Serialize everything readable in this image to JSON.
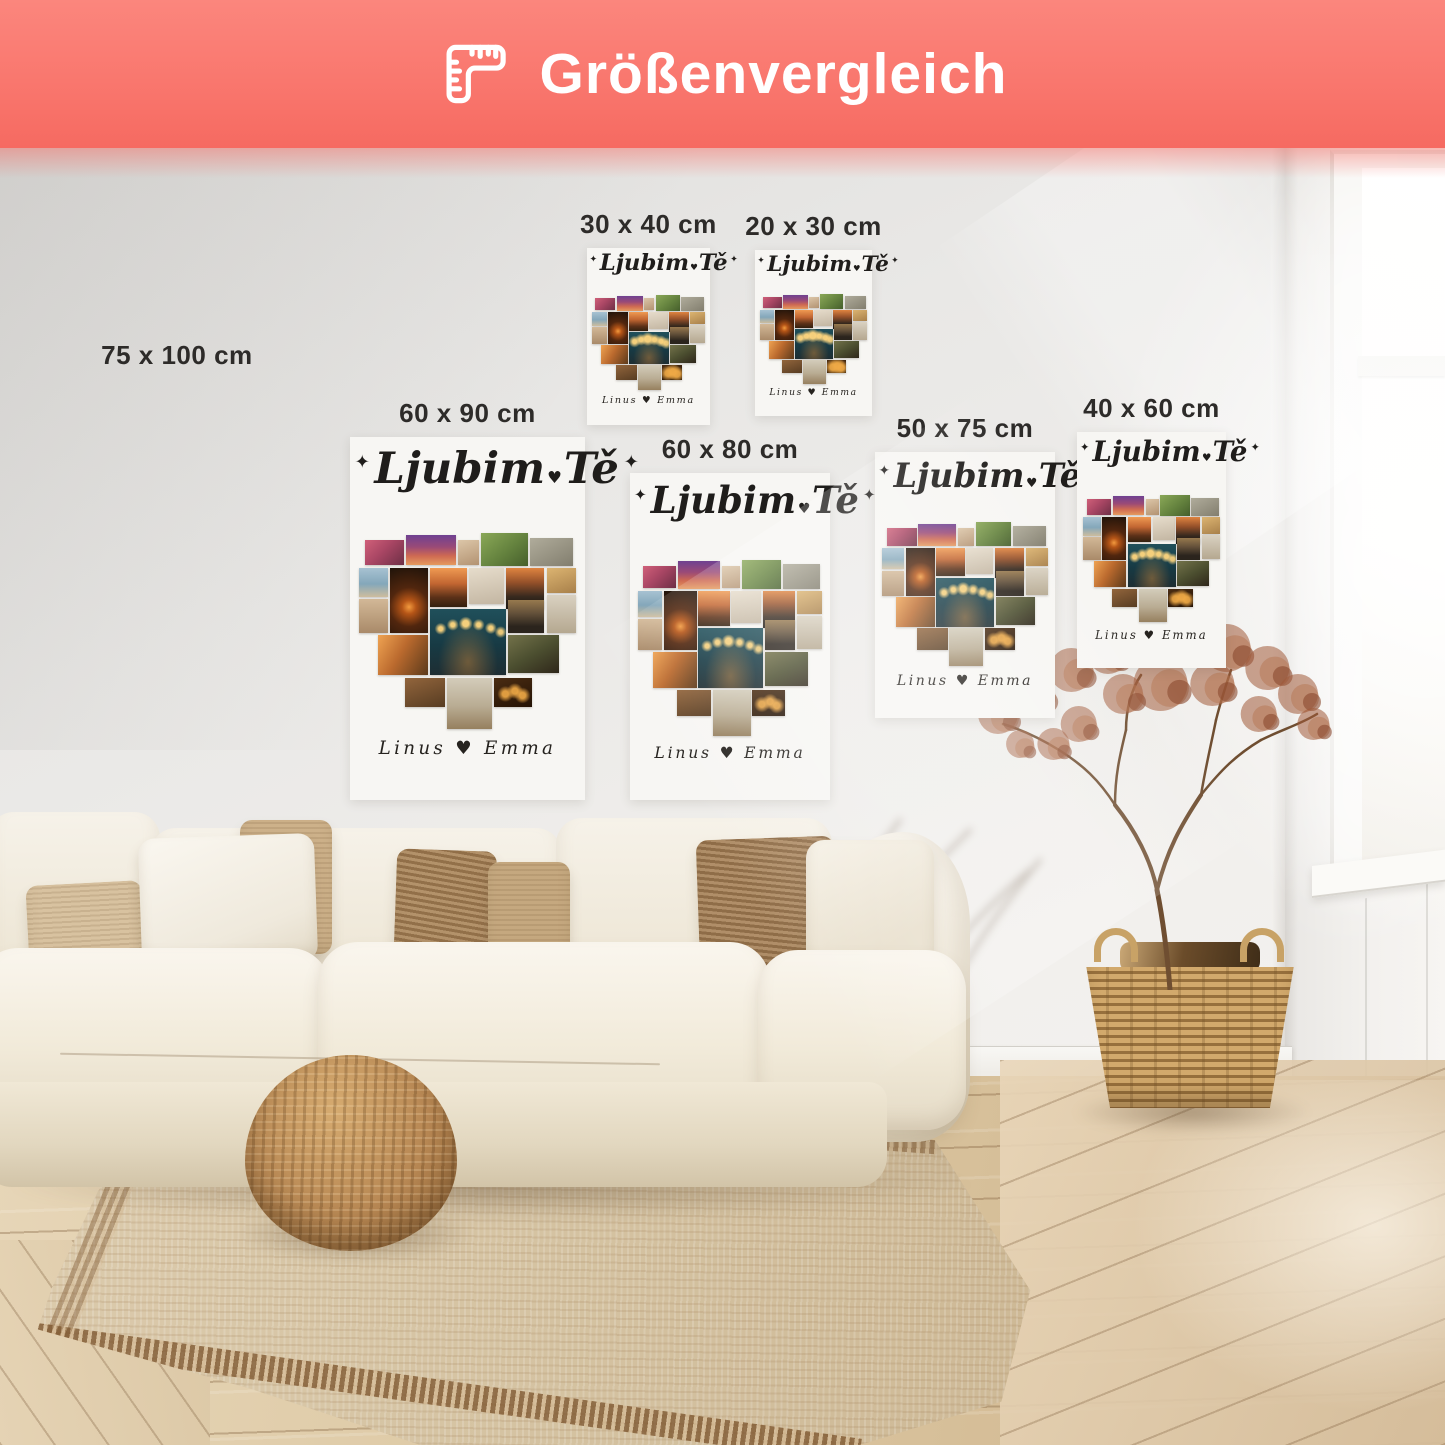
{
  "banner": {
    "title": "Größenvergleich",
    "icon": "ruler-icon",
    "bg_color": "#F9776E",
    "text_color": "#FFFFFF"
  },
  "poster_design": {
    "title_word1": "Ljubim",
    "title_word2": "Tě",
    "title_separator": "♥",
    "sparkle": "✦",
    "names": "Linus ♥ Emma",
    "ink_color": "#1F1D1B"
  },
  "sizes": [
    {
      "id": "75x100",
      "label": "75 x 100 cm",
      "print": false,
      "x": 7.0,
      "y": 23.5,
      "w": 9.5,
      "h": 2.5
    },
    {
      "id": "30x40",
      "label": "30 x 40 cm",
      "print": true,
      "x": 40.62,
      "y": 17.16,
      "w": 8.51,
      "h": 12.25
    },
    {
      "id": "20x30",
      "label": "20 x 30 cm",
      "print": true,
      "x": 52.25,
      "y": 17.3,
      "w": 8.1,
      "h": 11.49
    },
    {
      "id": "60x90",
      "label": "60 x 90 cm",
      "print": true,
      "x": 24.22,
      "y": 30.24,
      "w": 16.26,
      "h": 25.12
    },
    {
      "id": "60x80",
      "label": "60 x 80 cm",
      "print": true,
      "x": 43.6,
      "y": 32.73,
      "w": 13.84,
      "h": 22.63
    },
    {
      "id": "50x75",
      "label": "50 x 75 cm",
      "print": true,
      "x": 60.55,
      "y": 31.28,
      "w": 12.46,
      "h": 18.41
    },
    {
      "id": "40x60",
      "label": "40 x 60 cm",
      "print": true,
      "x": 74.53,
      "y": 29.9,
      "w": 10.31,
      "h": 16.33
    }
  ],
  "collage_tiles": [
    {
      "n": "photo-party",
      "c": "t1",
      "x": 2.8,
      "y": 3.6,
      "w": 18.0,
      "h": 12.6
    },
    {
      "n": "photo-palms-sunset",
      "c": "t2",
      "x": 21.8,
      "y": 0.8,
      "w": 23.0,
      "h": 15.6
    },
    {
      "n": "photo-beach-small",
      "c": "t3",
      "x": 45.8,
      "y": 3.6,
      "w": 9.4,
      "h": 12.6
    },
    {
      "n": "photo-picnic",
      "c": "t4",
      "x": 56.4,
      "y": 0.0,
      "w": 21.4,
      "h": 16.6
    },
    {
      "n": "photo-friends",
      "c": "t5",
      "x": 79.0,
      "y": 2.6,
      "w": 20.0,
      "h": 14.0
    },
    {
      "n": "photo-beach-walk",
      "c": "t6",
      "x": 0.0,
      "y": 17.6,
      "w": 13.2,
      "h": 15.0
    },
    {
      "n": "photo-campfire",
      "c": "t7",
      "x": 14.2,
      "y": 17.6,
      "w": 17.6,
      "h": 33.4
    },
    {
      "n": "photo-palm-beach",
      "c": "t8",
      "x": 32.8,
      "y": 17.6,
      "w": 17.0,
      "h": 20.0
    },
    {
      "n": "photo-group-light",
      "c": "t9",
      "x": 50.8,
      "y": 17.6,
      "w": 16.2,
      "h": 18.4
    },
    {
      "n": "photo-sea-sunset",
      "c": "t10",
      "x": 68.0,
      "y": 17.6,
      "w": 17.6,
      "h": 21.0
    },
    {
      "n": "photo-field",
      "c": "t11",
      "x": 86.6,
      "y": 17.6,
      "w": 13.4,
      "h": 13.0
    },
    {
      "n": "photo-sand-steps",
      "c": "t12",
      "x": 0.0,
      "y": 33.6,
      "w": 13.2,
      "h": 17.6
    },
    {
      "n": "photo-night-lights",
      "c": "t13",
      "x": 32.8,
      "y": 38.8,
      "w": 35.0,
      "h": 33.8
    },
    {
      "n": "photo-silhouettes",
      "c": "t14",
      "x": 68.8,
      "y": 34.0,
      "w": 16.8,
      "h": 17.0
    },
    {
      "n": "photo-couple-beach",
      "c": "t15",
      "x": 86.6,
      "y": 31.8,
      "w": 13.4,
      "h": 19.0
    },
    {
      "n": "photo-golden-hour",
      "c": "t16",
      "x": 8.4,
      "y": 52.2,
      "w": 23.4,
      "h": 20.4
    },
    {
      "n": "photo-bbq",
      "c": "t17",
      "x": 68.8,
      "y": 52.2,
      "w": 23.4,
      "h": 19.4
    },
    {
      "n": "photo-dinner",
      "c": "t18",
      "x": 21.0,
      "y": 73.8,
      "w": 18.6,
      "h": 14.8
    },
    {
      "n": "photo-family-beach",
      "c": "t19",
      "x": 40.6,
      "y": 73.8,
      "w": 20.6,
      "h": 26.2
    },
    {
      "n": "photo-candles",
      "c": "t20",
      "x": 62.2,
      "y": 73.8,
      "w": 17.8,
      "h": 14.8
    }
  ]
}
